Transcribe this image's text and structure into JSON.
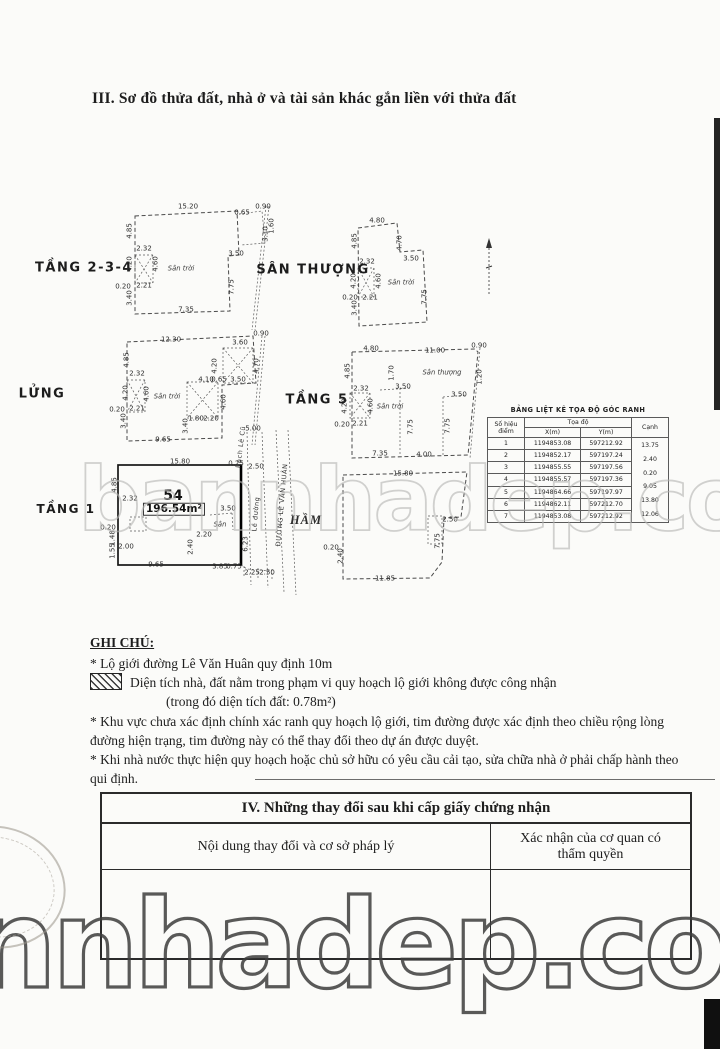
{
  "page": {
    "section3_title": "III. Sơ đồ thửa đất, nhà ở và tài sản khác gắn liền với thửa đất"
  },
  "diagram": {
    "parcel": {
      "number": "54",
      "area": "196.54m²"
    },
    "labels": [
      {
        "t": "TẦNG 2-3-4",
        "x": 84,
        "y": 268,
        "c": "floor"
      },
      {
        "t": "SÂN THƯỢNG",
        "x": 313,
        "y": 270,
        "c": "floor"
      },
      {
        "t": "LỬNG",
        "x": 42,
        "y": 394,
        "c": "floor"
      },
      {
        "t": "TẦNG 5",
        "x": 317,
        "y": 400,
        "c": "floor"
      },
      {
        "t": "TẦNG 1",
        "x": 66,
        "y": 509,
        "c": "floor",
        "s": 12
      },
      {
        "t": "HẦM",
        "x": 306,
        "y": 520,
        "c": "floor-it"
      },
      {
        "t": "Sân trời",
        "x": 181,
        "y": 269,
        "c": "area"
      },
      {
        "t": "Sân trời",
        "x": 401,
        "y": 283,
        "c": "area"
      },
      {
        "t": "Sân trời",
        "x": 167,
        "y": 397,
        "c": "area"
      },
      {
        "t": "Sân thượng",
        "x": 442,
        "y": 373,
        "c": "area"
      },
      {
        "t": "Sân trời",
        "x": 390,
        "y": 407,
        "c": "area"
      },
      {
        "t": "Sân",
        "x": 220,
        "y": 525,
        "c": "area"
      },
      {
        "t": "Rạch Lê Cũ",
        "x": 241,
        "y": 447,
        "r": -83,
        "c": "street"
      },
      {
        "t": "Lề đường",
        "x": 256,
        "y": 514,
        "r": -85,
        "c": "street"
      },
      {
        "t": "ĐƯỜNG LÊ VĂN HUÂN",
        "x": 282,
        "y": 505,
        "r": -85,
        "c": "street"
      },
      {
        "t": "54",
        "x": 173,
        "y": 496,
        "c": "pno"
      },
      {
        "t": "196.54m²",
        "x": 174,
        "y": 509,
        "c": "parea"
      },
      {
        "t": "15.20",
        "x": 188,
        "y": 207
      },
      {
        "t": "0.90",
        "x": 263,
        "y": 207
      },
      {
        "t": "0.65",
        "x": 242,
        "y": 213
      },
      {
        "t": "3.10",
        "x": 266,
        "y": 234,
        "r": -90
      },
      {
        "t": "1.60",
        "x": 272,
        "y": 226,
        "r": -90
      },
      {
        "t": "4.85",
        "x": 130,
        "y": 231,
        "r": -90
      },
      {
        "t": "2.32",
        "x": 144,
        "y": 249
      },
      {
        "t": "4.20",
        "x": 130,
        "y": 264,
        "r": -90
      },
      {
        "t": "4.60",
        "x": 156,
        "y": 264,
        "r": -90
      },
      {
        "t": "0.20",
        "x": 123,
        "y": 287
      },
      {
        "t": "2.21",
        "x": 144,
        "y": 286
      },
      {
        "t": "3.40",
        "x": 130,
        "y": 298,
        "r": -90
      },
      {
        "t": "3.50",
        "x": 236,
        "y": 254
      },
      {
        "t": "7.75",
        "x": 232,
        "y": 287,
        "r": -90
      },
      {
        "t": "7.35",
        "x": 186,
        "y": 310
      },
      {
        "t": "4.80",
        "x": 377,
        "y": 221
      },
      {
        "t": "4.85",
        "x": 355,
        "y": 241,
        "r": -90
      },
      {
        "t": "4.70",
        "x": 400,
        "y": 243,
        "r": -90
      },
      {
        "t": "3.50",
        "x": 411,
        "y": 259
      },
      {
        "t": "2.32",
        "x": 367,
        "y": 262
      },
      {
        "t": "4.20",
        "x": 354,
        "y": 281,
        "r": -90
      },
      {
        "t": "4.60",
        "x": 379,
        "y": 281,
        "r": -90
      },
      {
        "t": "2.21",
        "x": 370,
        "y": 298
      },
      {
        "t": "0.20",
        "x": 350,
        "y": 298
      },
      {
        "t": "3.40",
        "x": 355,
        "y": 308,
        "r": -90
      },
      {
        "t": "7.75",
        "x": 425,
        "y": 297,
        "r": -90
      },
      {
        "t": "12.30",
        "x": 171,
        "y": 340
      },
      {
        "t": "3.60",
        "x": 240,
        "y": 343
      },
      {
        "t": "0.90",
        "x": 261,
        "y": 334
      },
      {
        "t": "4.85",
        "x": 127,
        "y": 360,
        "r": -90
      },
      {
        "t": "2.32",
        "x": 137,
        "y": 374
      },
      {
        "t": "4.20",
        "x": 126,
        "y": 393,
        "r": -90
      },
      {
        "t": "4.60",
        "x": 147,
        "y": 394,
        "r": -90
      },
      {
        "t": "0.20",
        "x": 117,
        "y": 410
      },
      {
        "t": "2.21",
        "x": 137,
        "y": 409
      },
      {
        "t": "3.40",
        "x": 124,
        "y": 421,
        "r": -90
      },
      {
        "t": "4.10",
        "x": 206,
        "y": 380
      },
      {
        "t": "0.65",
        "x": 219,
        "y": 380
      },
      {
        "t": "4.60",
        "x": 224,
        "y": 402,
        "r": -90
      },
      {
        "t": "1.80",
        "x": 196,
        "y": 419
      },
      {
        "t": "2.20",
        "x": 211,
        "y": 419
      },
      {
        "t": "3.40",
        "x": 186,
        "y": 426,
        "r": -90
      },
      {
        "t": "4.20",
        "x": 215,
        "y": 366,
        "r": -90
      },
      {
        "t": "4.70",
        "x": 257,
        "y": 366,
        "r": -90
      },
      {
        "t": "3.50",
        "x": 238,
        "y": 380
      },
      {
        "t": "9.65",
        "x": 163,
        "y": 440
      },
      {
        "t": "5.00",
        "x": 253,
        "y": 429
      },
      {
        "t": "4.80",
        "x": 371,
        "y": 349
      },
      {
        "t": "11.00",
        "x": 435,
        "y": 351
      },
      {
        "t": "0.90",
        "x": 479,
        "y": 346
      },
      {
        "t": "4.85",
        "x": 348,
        "y": 371,
        "r": -90
      },
      {
        "t": "1.70",
        "x": 392,
        "y": 373,
        "r": -90
      },
      {
        "t": "2.32",
        "x": 361,
        "y": 389
      },
      {
        "t": "3.50",
        "x": 403,
        "y": 387
      },
      {
        "t": "4.20",
        "x": 345,
        "y": 406,
        "r": -90
      },
      {
        "t": "4.60",
        "x": 371,
        "y": 406,
        "r": -90
      },
      {
        "t": "0.20",
        "x": 342,
        "y": 425
      },
      {
        "t": "2.21",
        "x": 360,
        "y": 424
      },
      {
        "t": "3.50",
        "x": 459,
        "y": 395
      },
      {
        "t": "7.75",
        "x": 411,
        "y": 427,
        "r": -90
      },
      {
        "t": "7.75",
        "x": 448,
        "y": 426,
        "r": -90
      },
      {
        "t": "7.35",
        "x": 380,
        "y": 454
      },
      {
        "t": "4.00",
        "x": 424,
        "y": 455
      },
      {
        "t": "1.20",
        "x": 480,
        "y": 377,
        "r": -90
      },
      {
        "t": "15.80",
        "x": 180,
        "y": 462
      },
      {
        "t": "0.25",
        "x": 236,
        "y": 464
      },
      {
        "t": "2.50",
        "x": 256,
        "y": 467
      },
      {
        "t": "4.85",
        "x": 115,
        "y": 485,
        "r": -90
      },
      {
        "t": "2.32",
        "x": 130,
        "y": 499
      },
      {
        "t": "0.20",
        "x": 108,
        "y": 528
      },
      {
        "t": "1.48",
        "x": 113,
        "y": 538,
        "r": -90
      },
      {
        "t": "1.55",
        "x": 113,
        "y": 551,
        "r": -90
      },
      {
        "t": "2.00",
        "x": 126,
        "y": 547
      },
      {
        "t": "9.65",
        "x": 156,
        "y": 565
      },
      {
        "t": "3.85",
        "x": 220,
        "y": 567
      },
      {
        "t": "0.75",
        "x": 234,
        "y": 567
      },
      {
        "t": "2.25",
        "x": 252,
        "y": 573
      },
      {
        "t": "2.50",
        "x": 267,
        "y": 573
      },
      {
        "t": "3.50",
        "x": 228,
        "y": 509
      },
      {
        "t": "2.20",
        "x": 204,
        "y": 535
      },
      {
        "t": "2.40",
        "x": 191,
        "y": 547,
        "r": -90
      },
      {
        "t": "6.23",
        "x": 246,
        "y": 544,
        "r": -90
      },
      {
        "t": "15.80",
        "x": 403,
        "y": 474
      },
      {
        "t": "11.85",
        "x": 385,
        "y": 579
      },
      {
        "t": "0.20",
        "x": 331,
        "y": 548
      },
      {
        "t": "2.40",
        "x": 341,
        "y": 556,
        "r": -90
      },
      {
        "t": "2.50",
        "x": 450,
        "y": 520
      },
      {
        "t": "7.75",
        "x": 438,
        "y": 541,
        "r": -90
      }
    ]
  },
  "coord_table": {
    "title": "BẢNG LIỆT KÊ TỌA ĐỘ GÓC RANH",
    "headers": {
      "point": "Số hiệu điểm",
      "coords": "Tọa độ",
      "x": "X(m)",
      "y": "Y(m)",
      "edge": "Cạnh"
    },
    "rows": [
      {
        "p": "1",
        "x": "1194853.08",
        "y": "597212.92"
      },
      {
        "p": "2",
        "x": "1194852.17",
        "y": "597197.24"
      },
      {
        "p": "3",
        "x": "1194855.55",
        "y": "597197.56"
      },
      {
        "p": "4",
        "x": "1194855.57",
        "y": "597197.36"
      },
      {
        "p": "5",
        "x": "1194864.66",
        "y": "597197.97"
      },
      {
        "p": "6",
        "x": "1194862.11",
        "y": "597212.70"
      },
      {
        "p": "7",
        "x": "1194853.08",
        "y": "597212.92"
      }
    ],
    "edges": [
      "13.75",
      "2.40",
      "0.20",
      "9.05",
      "13.80",
      "12.06"
    ]
  },
  "notes": {
    "heading": "GHI CHÚ:",
    "items": [
      {
        "m": "*",
        "t": "Lộ giới đường Lê Văn Huân quy định 10m"
      },
      {
        "m": "h",
        "t": "Diện tích nhà, đất nằm trong phạm vi quy hoạch lộ giới không được công nhận"
      },
      {
        "m": "",
        "ind": true,
        "t": "(trong đó diện tích đất: 0.78m²)"
      },
      {
        "m": "*",
        "t": "Khu vực chưa xác định chính xác ranh quy hoạch lộ giới, tim đường được xác định theo chiều rộng lòng đường hiện trạng, tim đường này có thể thay đổi theo dự án được duyệt."
      },
      {
        "m": "*",
        "t": "Khi nhà nước thực hiện quy hoạch hoặc chủ sở hữu có yêu cầu cải tạo, sửa chữa nhà ở phải chấp hành theo qui định."
      }
    ]
  },
  "section4": {
    "title": "IV. Những thay đổi sau khi cấp giấy chứng nhận",
    "col1": "Nội dung thay đổi và cơ sở pháp lý",
    "col2": "Xác nhận của cơ quan có thẩm quyền"
  },
  "watermarks": {
    "middle": "bannhadep.com",
    "bottom": "nnhadep.com"
  }
}
